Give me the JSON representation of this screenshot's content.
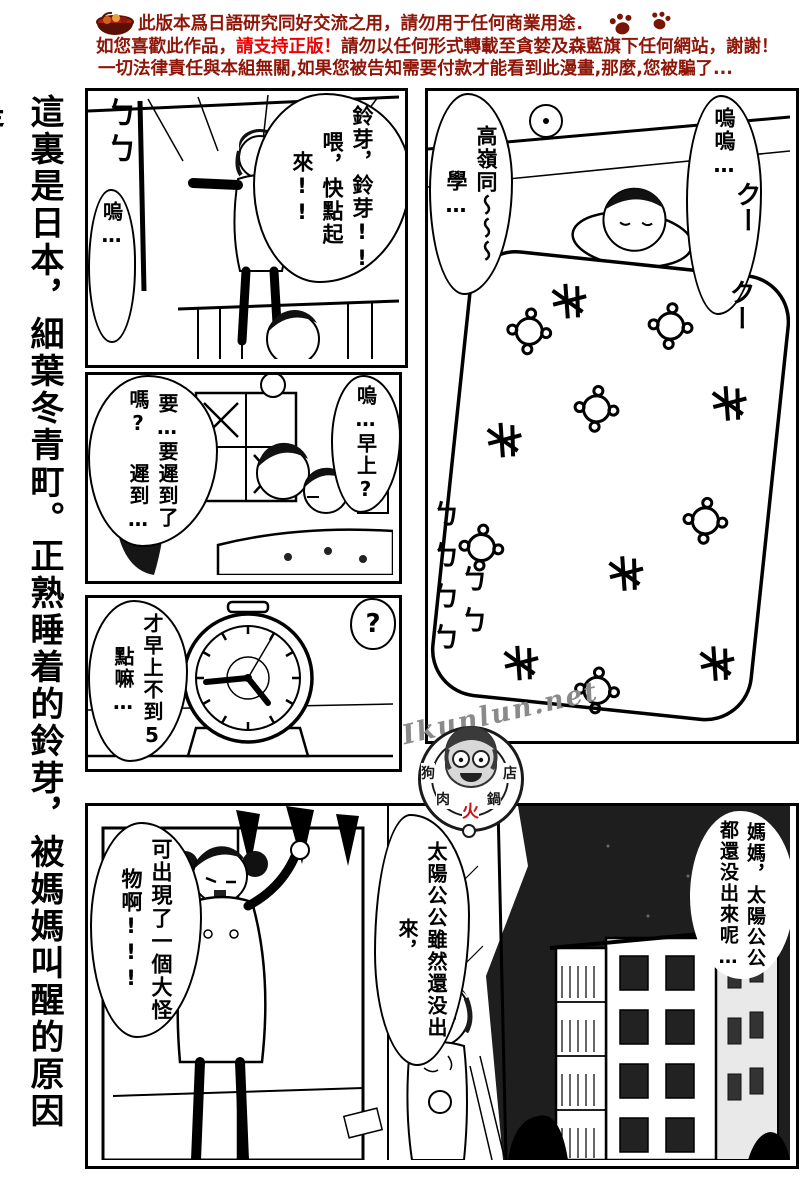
{
  "colors": {
    "page_bg": "#ffffff",
    "ink": "#000000",
    "header_red": "#8e1507",
    "highlight_red": "#ee0000",
    "night_sky": "#1e1e1e",
    "watermark_gray": "#8a8a8a",
    "logo_red": "#cc1111"
  },
  "header": {
    "icon": "hotpot-bowl-icon",
    "line1": "此版本爲日語研究同好交流之用，請勿用于任何商業用途．",
    "line1_trailing_icon": "paw-prints-icon",
    "line2_prefix": "如您喜歡此作品，",
    "line2_highlight": "請支持正版！",
    "line2_suffix": "請勿以任何形式轉載至貪婪及森藍旗下任何網站，謝謝！",
    "line3": "一切法律責任與本組無關,如果您被告知需要付款才能看到此漫畫,那麼,您被騙了..."
  },
  "side_caption": "這裏是日本，細葉冬青町。正熟睡着的鈴芽，被媽媽叫醒的原因是…………!!",
  "panels": {
    "wake": {
      "bubble_main": "鈴芽，鈴芽!! 喂，快點起來!!",
      "bubble_sleep": "嗚…",
      "sfx_curtain": "ㄅㄅ"
    },
    "futon": {
      "bubble_call": "高嶺同～～～學…",
      "bubble_moan": "嗚嗚…",
      "sfx_breath": "クー",
      "sfx_snore_a": "ㄅㄅㄅㄅ",
      "sfx_snore_b": "ㄅㄅ"
    },
    "morning": {
      "bubble_late": "要…要遲到了嗎? 遲到…",
      "bubble_wake": "嗚…早上?"
    },
    "clock": {
      "bubble_early": "才早上不到5點嘛…",
      "bubble_question": "?",
      "time_shown": "04:44"
    },
    "dawn": {
      "mother_shout": "可出現了一個大怪物啊!!!",
      "girl_line": "太陽公公雖然還没出來，",
      "right_line": "媽媽，太陽公公都還没出來呢…"
    }
  },
  "watermark": {
    "site": "Ikunlun.net",
    "ring_1": "狗",
    "ring_2": "肉",
    "ring_3": "火",
    "ring_4": "鍋",
    "ring_5": "店"
  }
}
